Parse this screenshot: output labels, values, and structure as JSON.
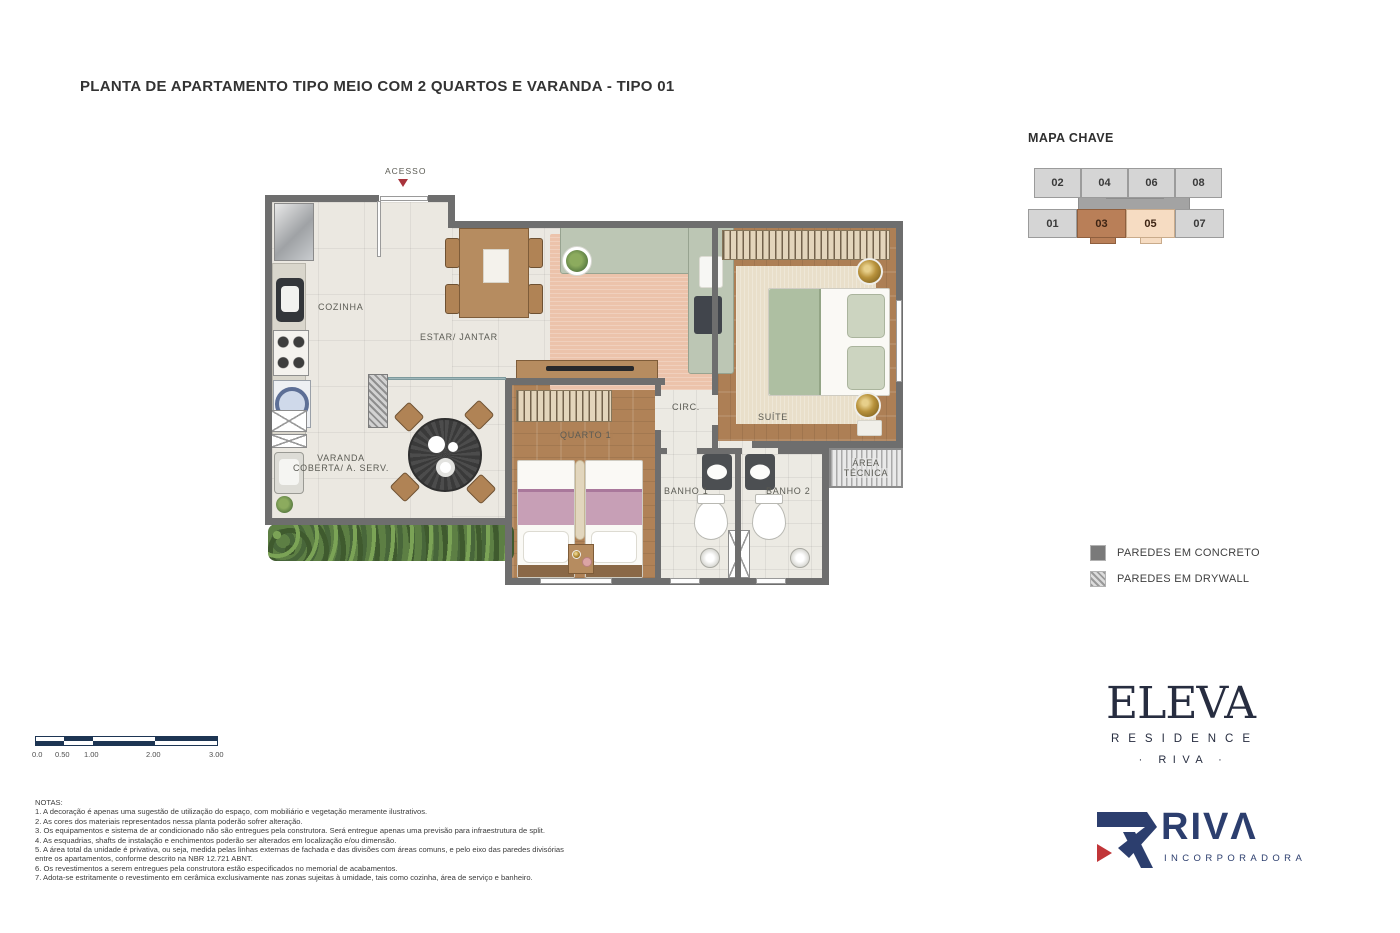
{
  "title": "PLANTA DE APARTAMENTO TIPO MEIO COM 2 QUARTOS E VARANDA - TIPO 01",
  "floor_plan": {
    "access_label": "ACESSO",
    "rooms": {
      "cozinha": "COZINHA",
      "estar_jantar": "ESTAR/ JANTAR",
      "varanda_line1": "VARANDA",
      "varanda_line2": "COBERTA/ A. SERV.",
      "quarto1": "QUARTO 1",
      "circ": "CIRC.",
      "suite": "SUÍTE",
      "banho1": "BANHO 1",
      "banho2": "BANHO 2",
      "area_tecnica_line1": "ÁREA",
      "area_tecnica_line2": "TÉCNICA"
    }
  },
  "key_map": {
    "title": "MAPA CHAVE",
    "units_top": [
      "02",
      "04",
      "06",
      "08"
    ],
    "units_bottom": [
      "01",
      "03",
      "05",
      "07"
    ],
    "highlighted_unit": "03",
    "secondary_highlight_unit": "05",
    "colors": {
      "unit_default": "#d5d5d5",
      "unit_highlight": "#b97f58",
      "unit_secondary": "#f6dcc2",
      "core": "#a3a3a3"
    }
  },
  "legend": {
    "items": [
      {
        "label": "PAREDES EM CONCRETO",
        "style": "solid",
        "color": "#7a7a7a"
      },
      {
        "label": "PAREDES EM DRYWALL",
        "style": "hatched",
        "color": "#9a9a9a"
      }
    ]
  },
  "scale_bar": {
    "labels": [
      "0.0",
      "0.50",
      "1.00",
      "2.00",
      "3.00"
    ],
    "color": "#1d3553"
  },
  "notes": {
    "title": "NOTAS:",
    "lines": [
      "1. A decoração é apenas uma sugestão de utilização do espaço, com mobiliário e vegetação meramente ilustrativos.",
      "2. As cores dos materiais representados nessa planta poderão sofrer alteração.",
      "3. Os equipamentos e sistema de ar condicionado não são entregues pela construtora. Será entregue apenas uma previsão para infraestrutura de split.",
      "4. As esquadrias, shafts de instalação e enchimentos poderão ser alterados em localização e/ou dimensão.",
      "5. A área total da unidade é privativa, ou seja, medida pelas linhas externas de fachada e das divisões com áreas comuns, e pelo eixo das paredes divisórias entre os apartamentos, conforme descrito na NBR 12.721 ABNT.",
      "6. Os revestimentos a serem entregues pela construtora estão especificados no memorial de acabamentos.",
      "7. Adota-se estritamente o revestimento em cerâmica exclusivamente nas zonas sujeitas à umidade, tais como cozinha, área de serviço e banheiro."
    ]
  },
  "brand": {
    "eleva_logo": "ELEVA",
    "eleva_residence": "RESIDENCE",
    "eleva_riva": "· RIVA ·",
    "riva_logo_text": "RIVΛ",
    "riva_sub": "INCORPORADORA",
    "navy": "#2c3e6e",
    "red": "#c13538"
  }
}
